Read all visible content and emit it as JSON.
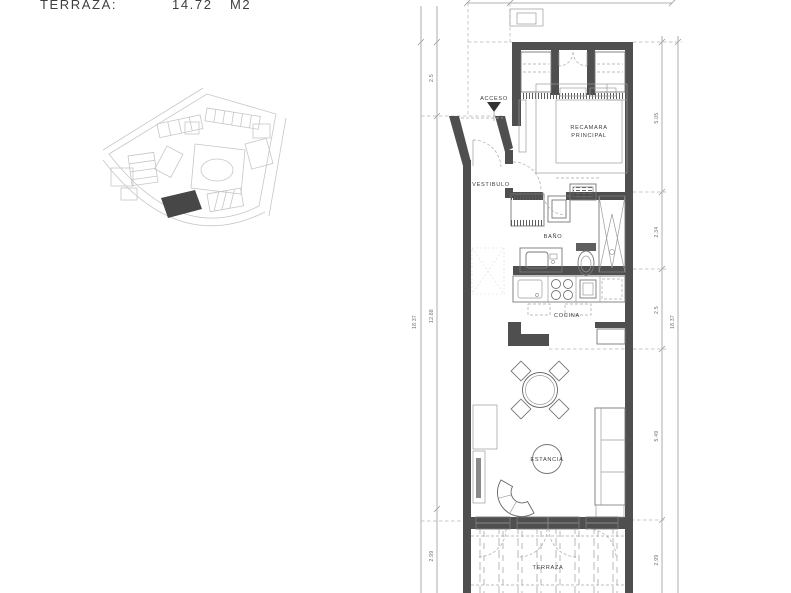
{
  "header": {
    "label": "TERRAZA:",
    "value": "14.72",
    "unit": "M2"
  },
  "site_plan": {
    "description": "site-location-sketch",
    "highlight_color": "#1a1a1a",
    "line_color": "#b9b9b9"
  },
  "floor_plan": {
    "labels": {
      "acceso": "ACCESO",
      "vestibulo": "VESTIBULO",
      "bano": "BAÑO",
      "recamara_line1": "RECAMARA",
      "recamara_line2": "PRINCIPAL",
      "cocina": "COCINA",
      "estancia": "ESTANCIA",
      "terraza": "TERRAZA"
    },
    "dimensions": {
      "left": {
        "total": "18.37",
        "segments": [
          "2.5",
          "12.88",
          "2.99"
        ]
      },
      "right": {
        "total": "18.37",
        "segments": [
          "5.05",
          "2.34",
          "2.5",
          "5.49",
          "2.99"
        ]
      }
    },
    "colors": {
      "wall": "#4f4f4f",
      "dim_line": "#9a9a9a",
      "text": "#3c3c3c"
    }
  }
}
